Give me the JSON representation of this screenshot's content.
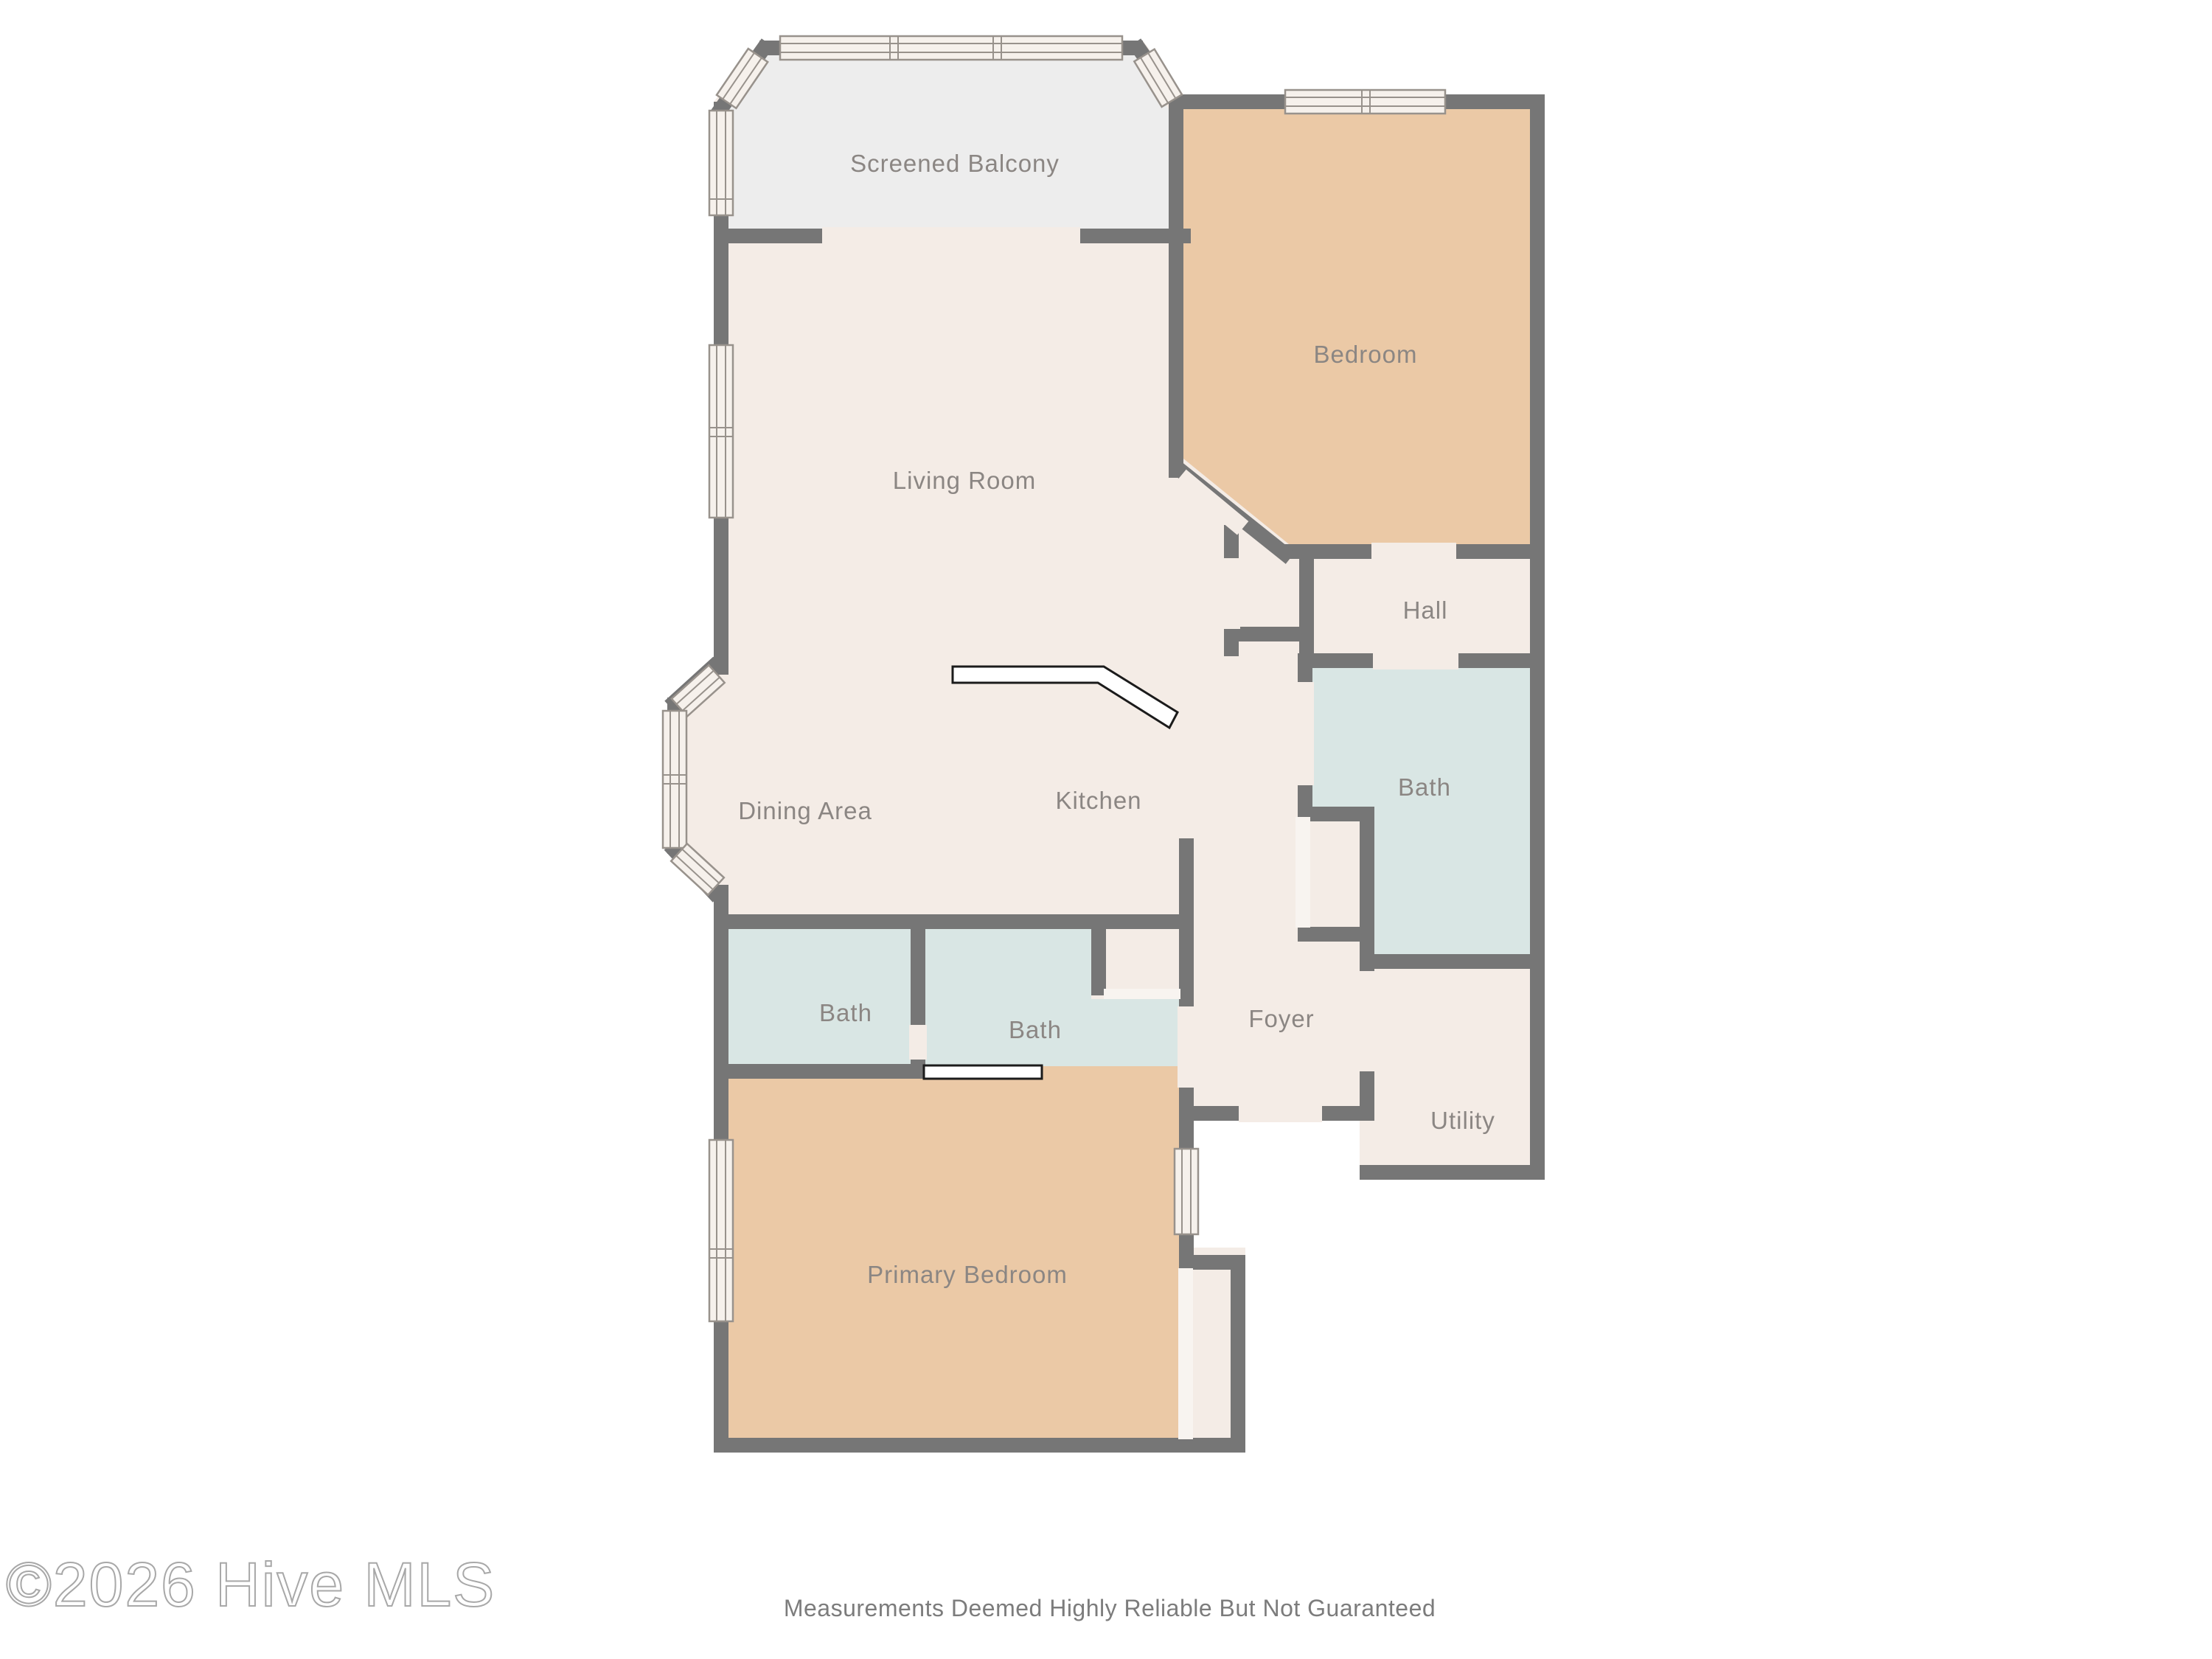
{
  "rooms": {
    "balcony": {
      "label": "Screened Balcony"
    },
    "bedroom": {
      "label": "Bedroom"
    },
    "living": {
      "label": "Living Room"
    },
    "hall": {
      "label": "Hall"
    },
    "bath_right": {
      "label": "Bath"
    },
    "dining": {
      "label": "Dining Area"
    },
    "kitchen": {
      "label": "Kitchen"
    },
    "bath_a": {
      "label": "Bath"
    },
    "bath_b": {
      "label": "Bath"
    },
    "foyer": {
      "label": "Foyer"
    },
    "utility": {
      "label": "Utility"
    },
    "primary": {
      "label": "Primary Bedroom"
    }
  },
  "footer": {
    "watermark": "©2026 Hive MLS",
    "disclaimer": "Measurements Deemed Highly Reliable But Not Guaranteed"
  },
  "colors": {
    "wall": "#767676",
    "room_cream": "#f4ece6",
    "balcony_gray": "#ededed",
    "bedroom_tan": "#ebc9a6",
    "bath_blue": "#d9e6e4",
    "label_gray": "#8b8683",
    "window_fill": "#f6f1ec",
    "threshold": "#f4ece6",
    "door_white": "#f8f4f0"
  }
}
